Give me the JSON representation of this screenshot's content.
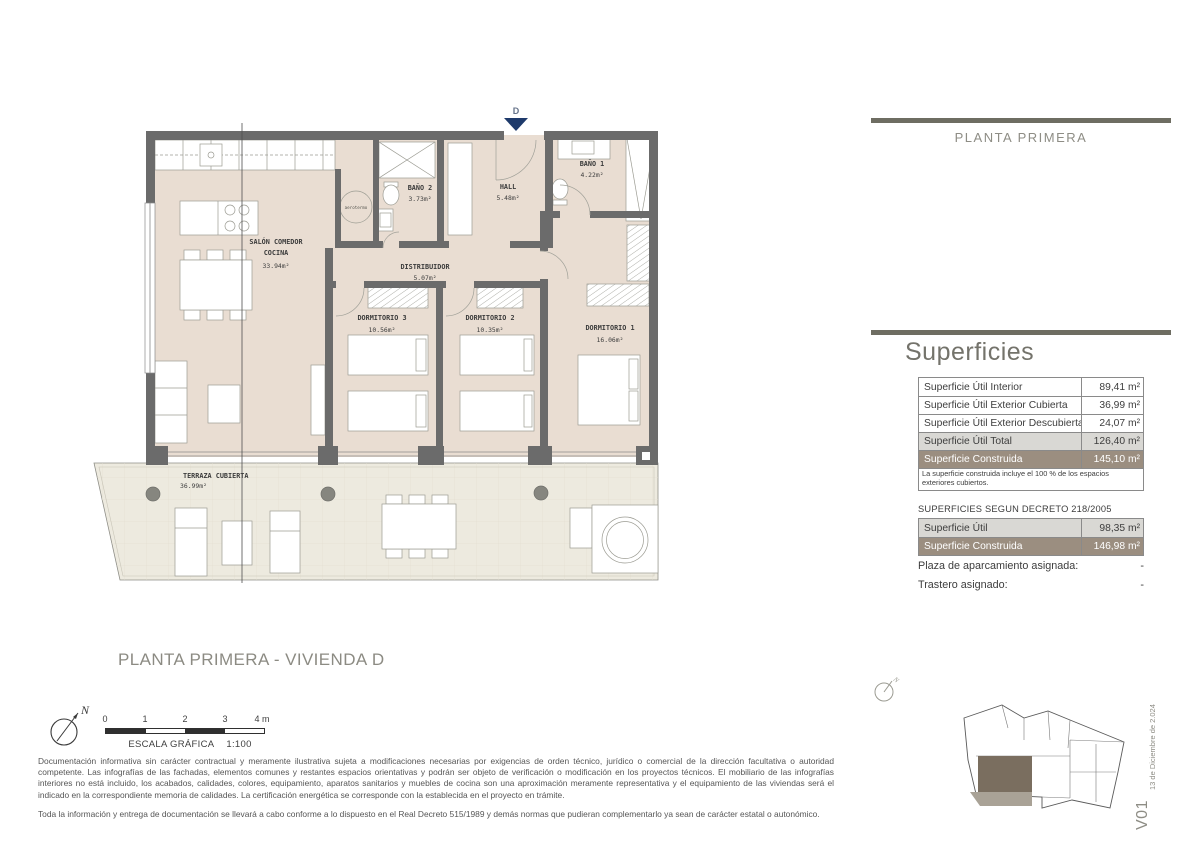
{
  "right_panel": {
    "header_title": "PLANTA PRIMERA",
    "section_title": "Superficies",
    "areas_table": {
      "rows": [
        {
          "label": "Superficie Útil Interior",
          "value": "89,41 m²"
        },
        {
          "label": "Superficie Útil Exterior Cubierta",
          "value": "36,99 m²"
        },
        {
          "label": "Superficie Útil Exterior Descubierta",
          "value": "24,07 m²"
        },
        {
          "label": "Superficie Útil Total",
          "value": "126,40 m²"
        },
        {
          "label": "Superficie Construida",
          "value": "145,10 m²"
        }
      ],
      "note": "La superficie construida incluye el 100 % de los espacios exteriores cubiertos."
    },
    "decreto_title": "SUPERFICIES SEGUN DECRETO 218/2005",
    "decreto_table": {
      "rows": [
        {
          "label": "Superficie Útil",
          "value": "98,35 m²"
        },
        {
          "label": "Superficie Construida",
          "value": "146,98 m²"
        }
      ]
    },
    "assignments": [
      {
        "label": "Plaza de aparcamiento asignada:",
        "value": "-"
      },
      {
        "label": "Trastero asignado:",
        "value": "-"
      }
    ],
    "version": "V01",
    "version_date": "13 de Diciembre de 2.024",
    "north_label": "N"
  },
  "plan": {
    "entrance_marker": "D",
    "aerotermo_label": "aerotermo",
    "rooms": [
      {
        "name": "SALÓN COMEDOR",
        "name2": "COCINA",
        "area": "33.94m²"
      },
      {
        "name": "BAÑO 2",
        "area": "3.73m²"
      },
      {
        "name": "HALL",
        "area": "5.48m²"
      },
      {
        "name": "BAÑO 1",
        "area": "4.22m²"
      },
      {
        "name": "DISTRIBUIDOR",
        "area": "5.07m²"
      },
      {
        "name": "DORMITORIO 3",
        "area": "10.56m²"
      },
      {
        "name": "DORMITORIO 2",
        "area": "10.35m²"
      },
      {
        "name": "DORMITORIO 1",
        "area": "16.06m²"
      },
      {
        "name": "TERRAZA CUBIERTA",
        "area": "36.99m²"
      }
    ]
  },
  "footer": {
    "plan_title": "PLANTA PRIMERA - VIVIENDA D",
    "north_label": "N",
    "scale_ticks": [
      "0",
      "1",
      "2",
      "3",
      "4 m"
    ],
    "scale_label": "ESCALA GRÁFICA",
    "scale_ratio": "1:100",
    "disclaimer_1": "Documentación informativa sin carácter contractual y meramente ilustrativa sujeta a modificaciones necesarias por exigencias de orden técnico, jurídico o comercial de la dirección facultativa o autoridad competente. Las infografías de las fachadas, elementos comunes y restantes espacios orientativas y podrán ser objeto de verificación o modificación en los proyectos técnicos. El mobiliario de las infografías interiores no está incluido, los acabados, calidades, colores, equipamiento, aparatos sanitarios y muebles de cocina son una aproximación meramente representativa y el equipamiento de las viviendas será el indicado en la correspondiente memoria de calidades. La certificación energética se corresponde con la establecida en el proyecto en trámite.",
    "disclaimer_2": "Toda la información y entrega de documentación se llevará a cabo conforme a lo dispuesto en el Real Decreto 515/1989 y demás normas que pudieran complementarlo ya sean de carácter estatal o autonómico."
  },
  "colors": {
    "accent_bar": "#6e6d62",
    "heading_text": "#8e8d85",
    "wall": "#6b6b6b",
    "floor": "#e9ddd2",
    "terrace_floor": "#edeadf",
    "row_highlight": "#d9d8d4",
    "row_construida": "#9b8e80",
    "entrance_marker_blue": "#1e3a6b",
    "site_unit_dark": "#7a6e5f",
    "site_unit_light": "#a9a296"
  }
}
